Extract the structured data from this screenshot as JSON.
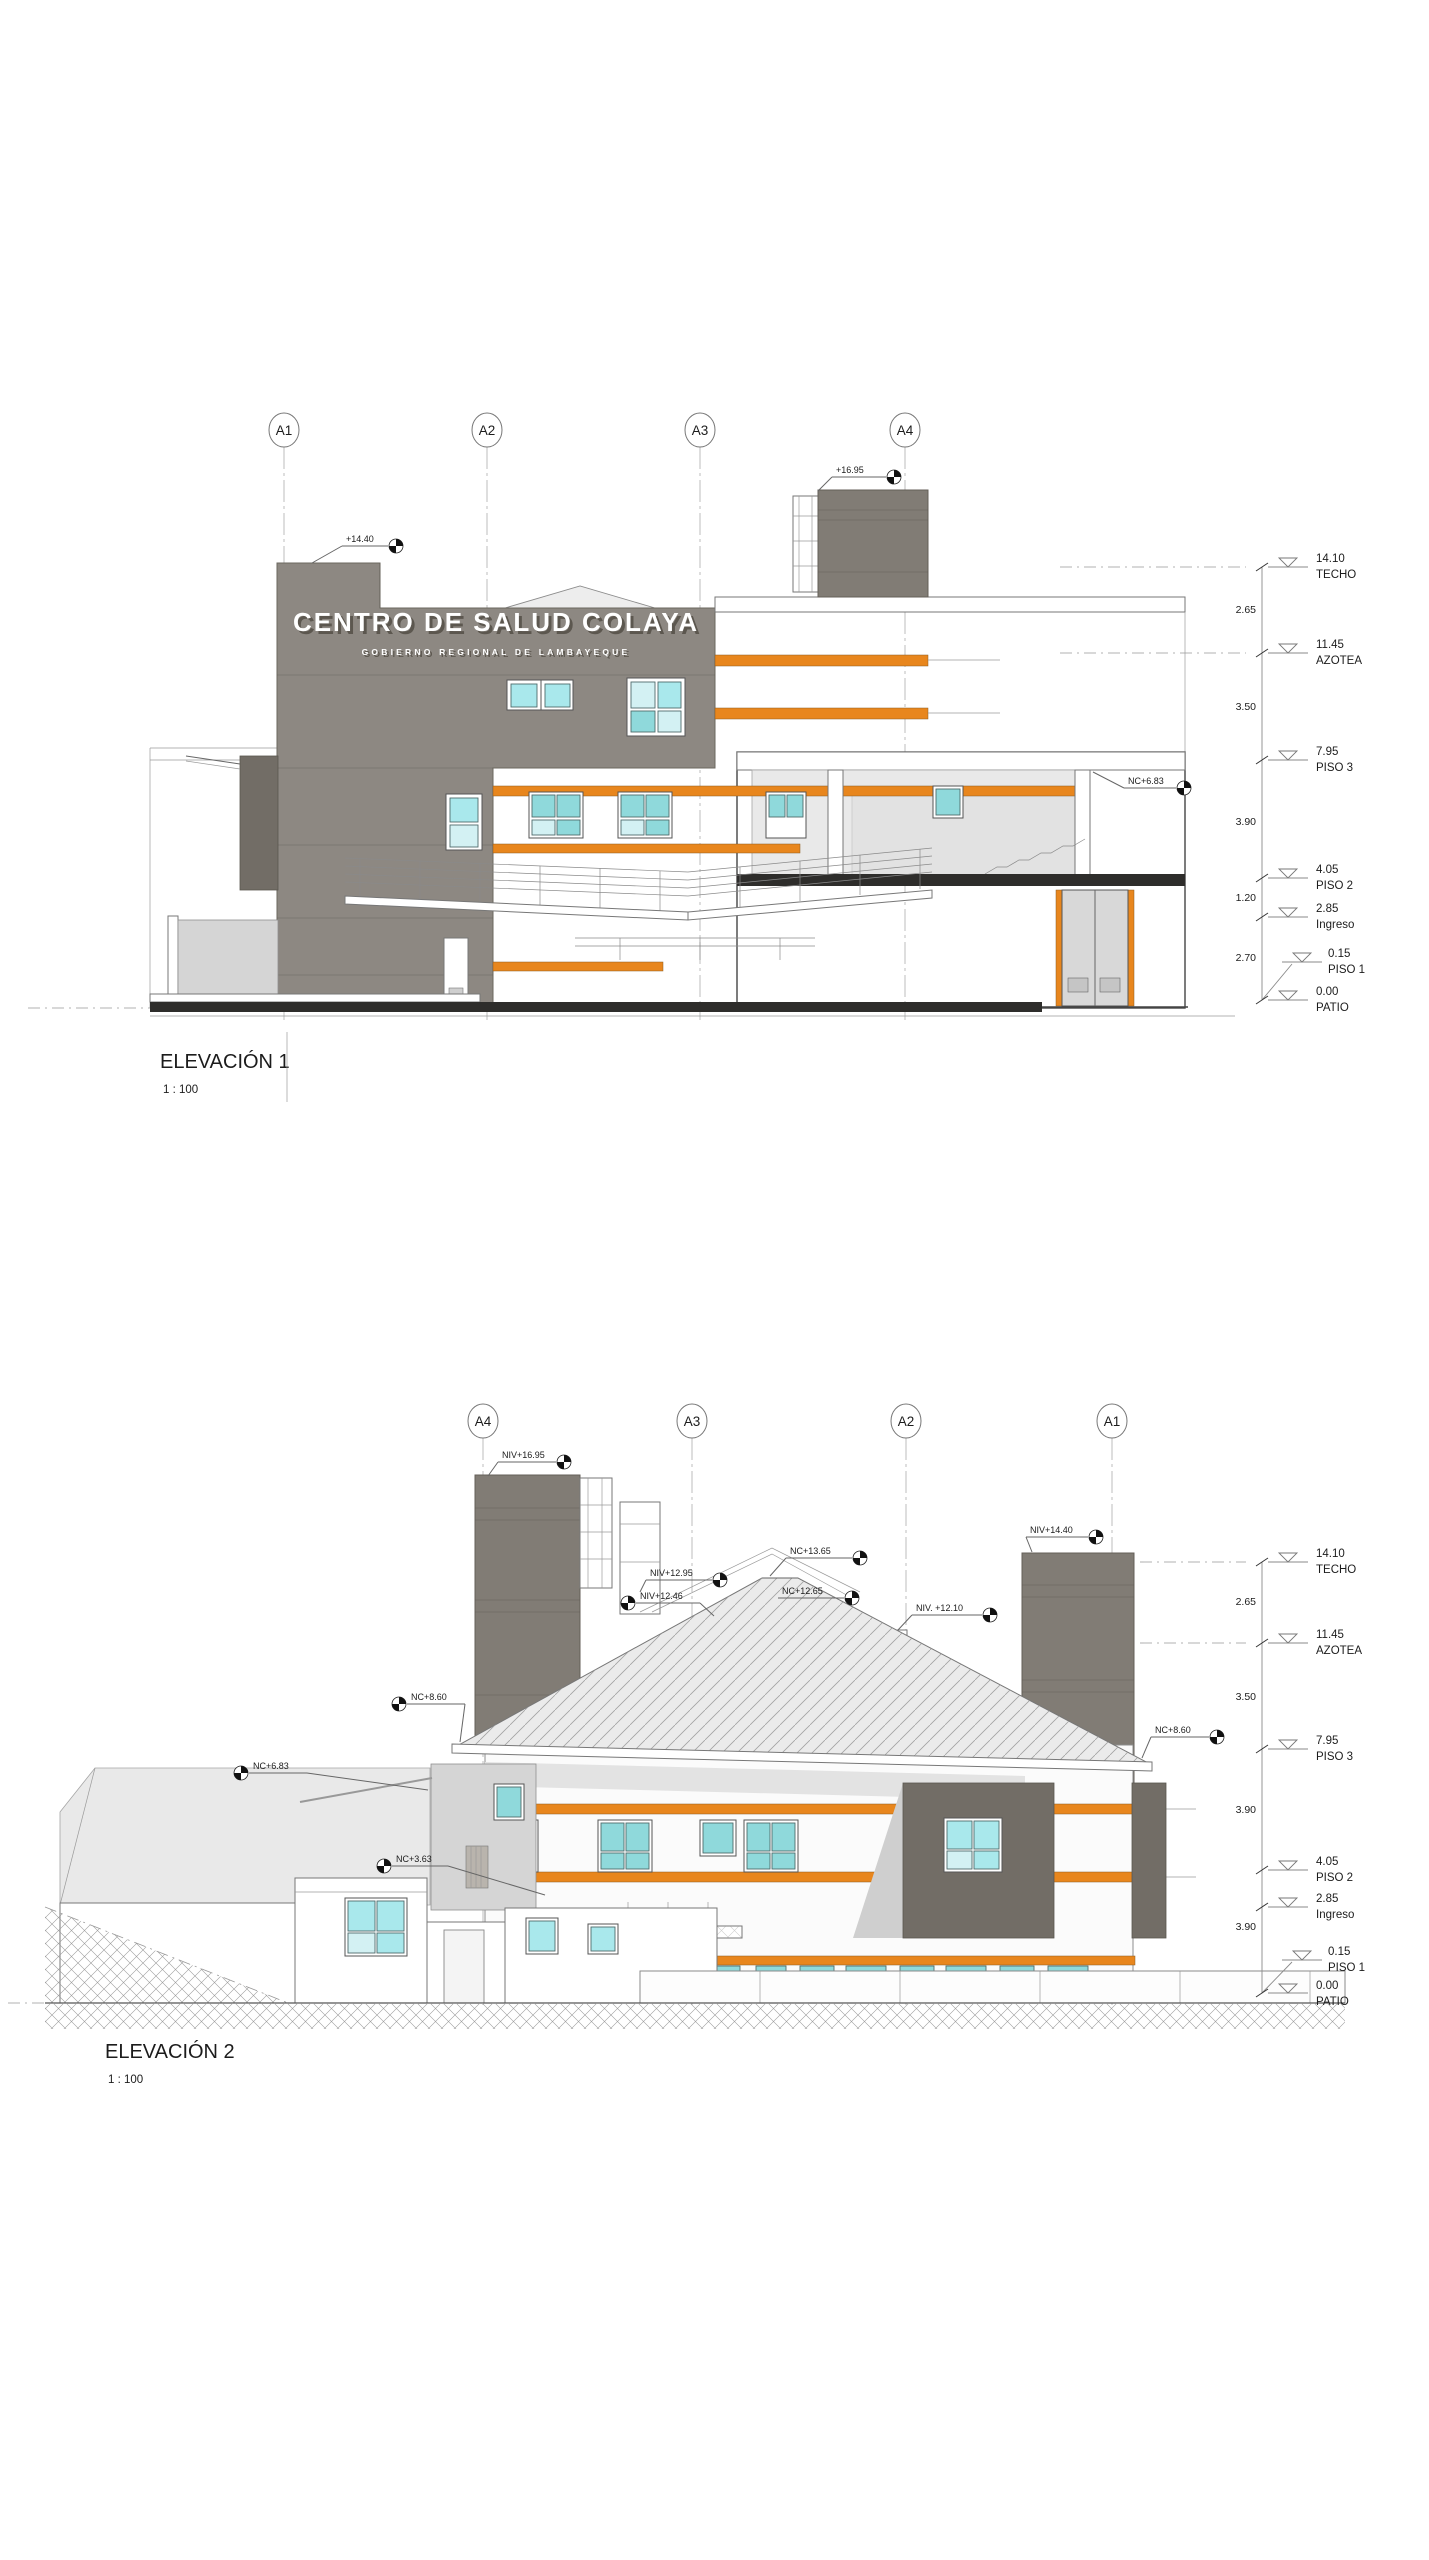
{
  "document": {
    "type": "architectural-elevation-sheet",
    "accent_orange": "#E8861D",
    "facade_gray": "#8D8882",
    "window_cyan": "#A9E8EC"
  },
  "elevation1": {
    "title": "ELEVACIÓN 1",
    "scale": "1 : 100",
    "grids": [
      "A1",
      "A2",
      "A3",
      "A4"
    ],
    "sign": {
      "line1": "CENTRO DE SALUD COLAYA",
      "line2": "GOBIERNO REGIONAL DE LAMBAYEQUE"
    },
    "spots": [
      "+14.40",
      "+16.95",
      "NC+6.83"
    ],
    "levels": [
      {
        "value": "14.10",
        "name": "TECHO"
      },
      {
        "value": "11.45",
        "name": "AZOTEA"
      },
      {
        "value": "7.95",
        "name": "PISO 3"
      },
      {
        "value": "4.05",
        "name": "PISO 2"
      },
      {
        "value": "2.85",
        "name": "Ingreso"
      },
      {
        "value": "0.15",
        "name": "PISO 1"
      },
      {
        "value": "0.00",
        "name": "PATIO"
      }
    ],
    "dims": [
      "2.65",
      "3.50",
      "3.90",
      "1.20",
      "2.70"
    ]
  },
  "elevation2": {
    "title": "ELEVACIÓN 2",
    "scale": "1 : 100",
    "grids": [
      "A4",
      "A3",
      "A2",
      "A1"
    ],
    "spots": [
      "NIV+16.95",
      "NIV+12.95",
      "NIV+12.46",
      "NC+13.65",
      "NC+12.65",
      "NIV. +12.10",
      "NIV+14.40",
      "NC+8.60",
      "NC+6.83",
      "NC+3.63",
      "NC+8.60"
    ],
    "levels": [
      {
        "value": "14.10",
        "name": "TECHO"
      },
      {
        "value": "11.45",
        "name": "AZOTEA"
      },
      {
        "value": "7.95",
        "name": "PISO 3"
      },
      {
        "value": "4.05",
        "name": "PISO 2"
      },
      {
        "value": "2.85",
        "name": "Ingreso"
      },
      {
        "value": "0.15",
        "name": "PISO 1"
      },
      {
        "value": "0.00",
        "name": "PATIO"
      }
    ],
    "dims": [
      "2.65",
      "3.50",
      "3.90",
      "3.90"
    ]
  }
}
